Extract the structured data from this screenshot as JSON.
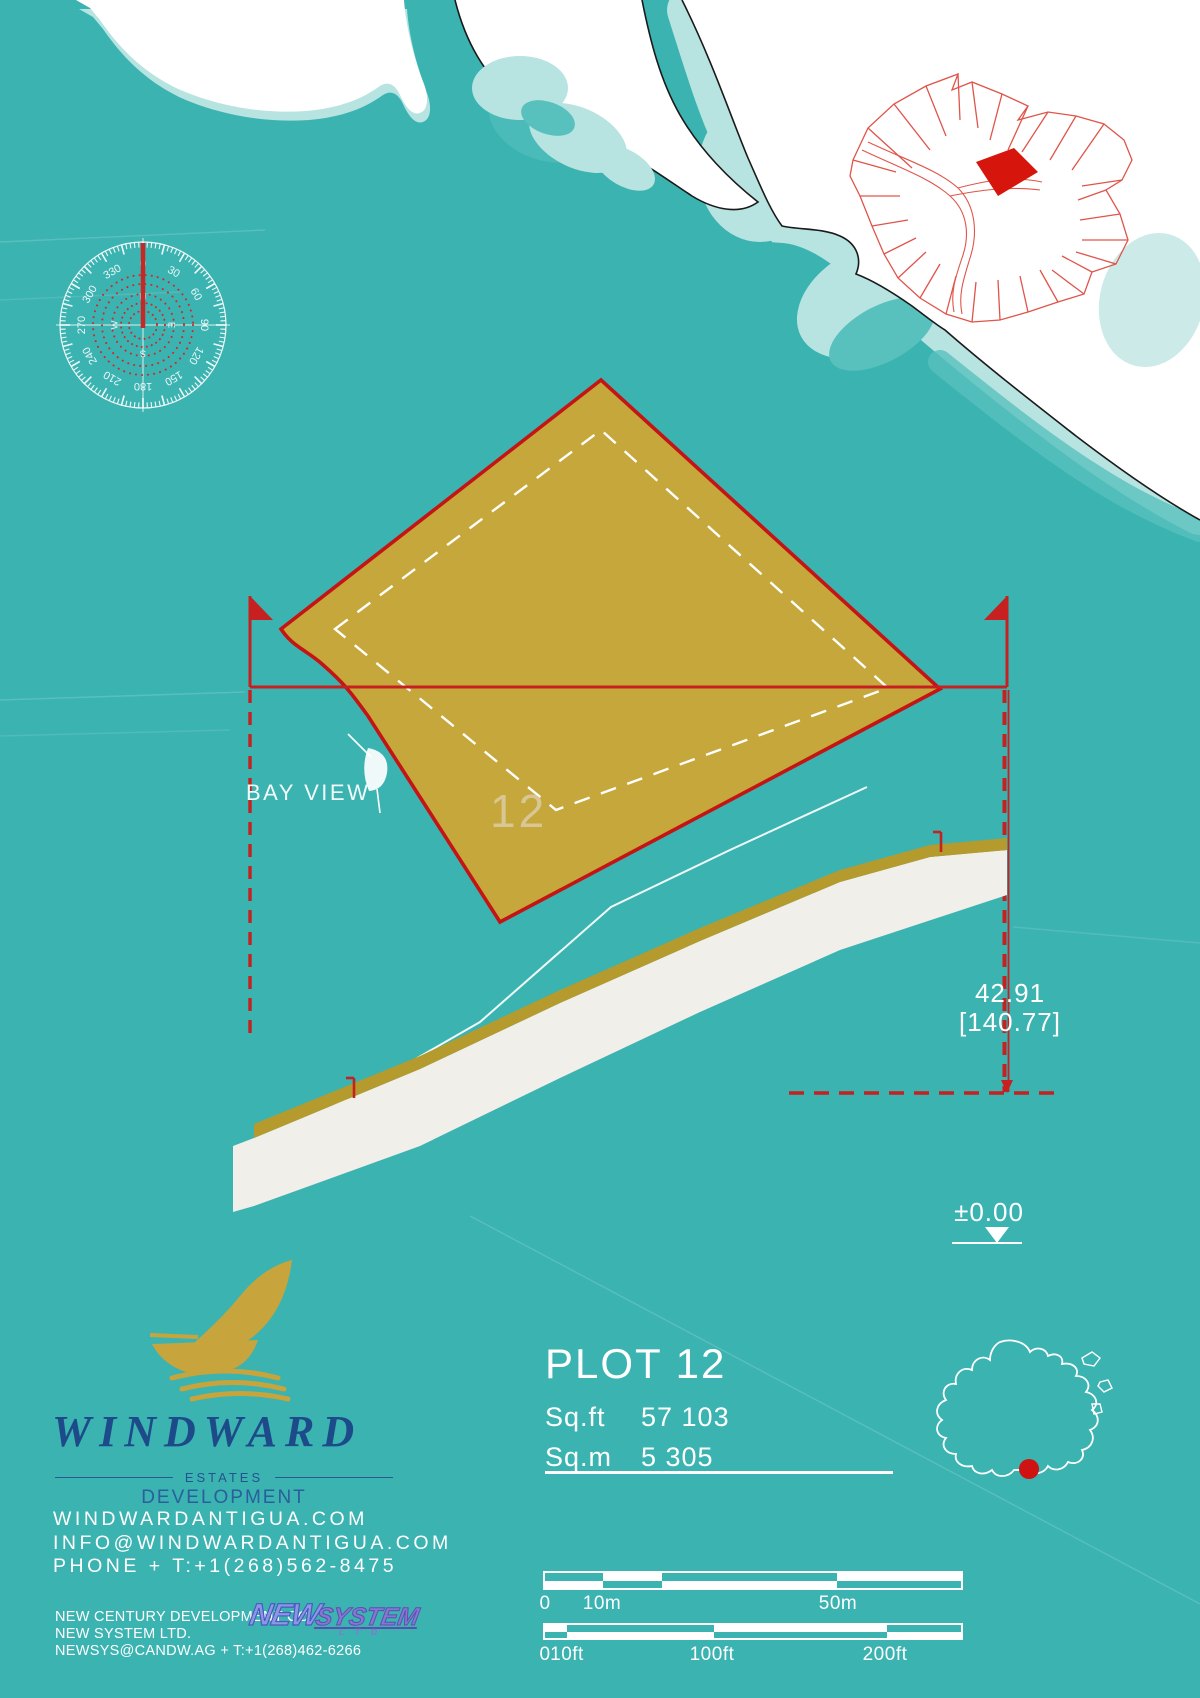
{
  "compass": {
    "degrees": [
      "0",
      "30",
      "60",
      "90",
      "120",
      "150",
      "180",
      "210",
      "240",
      "270",
      "300",
      "330"
    ],
    "cardinals": [
      "N",
      "E",
      "S",
      "W"
    ]
  },
  "site_plan": {
    "plot_number": "12",
    "bay_view_label": "BAY VIEW",
    "dimension_value": "42.91",
    "dimension_secondary": "[140.77]",
    "datum_label": "±0.00"
  },
  "plot_info": {
    "title": "PLOT 12",
    "area_sqft_label": "Sq.ft",
    "area_sqft_value": "57 103",
    "area_sqm_label": "Sq.m",
    "area_sqm_value": "5 305"
  },
  "branding": {
    "name": "WINDWARD",
    "subtitle": "ESTATES",
    "division": "DEVELOPMENT",
    "website": "WINDWARDANTIGUA.COM",
    "email": "INFO@WINDWARDANTIGUA.COM",
    "phone": "PHONE + T:+1(268)562-8475"
  },
  "developer": {
    "line1": "NEW CENTURY DEVELOPMENT CO.",
    "line2": "NEW SYSTEM LTD.",
    "line3": "NEWSYS@CANDW.AG + T:+1(268)462-6266",
    "logo_new": "NEW",
    "logo_system": "SYSTEM",
    "logo_ltd": "L T D"
  },
  "scale_bars": {
    "metric": {
      "labels": [
        "0",
        "10m",
        "50m"
      ]
    },
    "imperial": {
      "labels": [
        "0",
        "10ft",
        "100ft",
        "200ft"
      ]
    }
  },
  "colors": {
    "sea": "#3BB3B1",
    "shallow_water": "#B7E3E1",
    "mid_water": "#58C1BE",
    "land": "#FFFFFF",
    "plot_fill": "#C6A73B",
    "plot_outline": "#C41414",
    "accent_red": "#CC1616",
    "inset_red": "#E0544A",
    "brand_navy": "#1D4B8A",
    "brand_gold": "#C8A43C"
  }
}
